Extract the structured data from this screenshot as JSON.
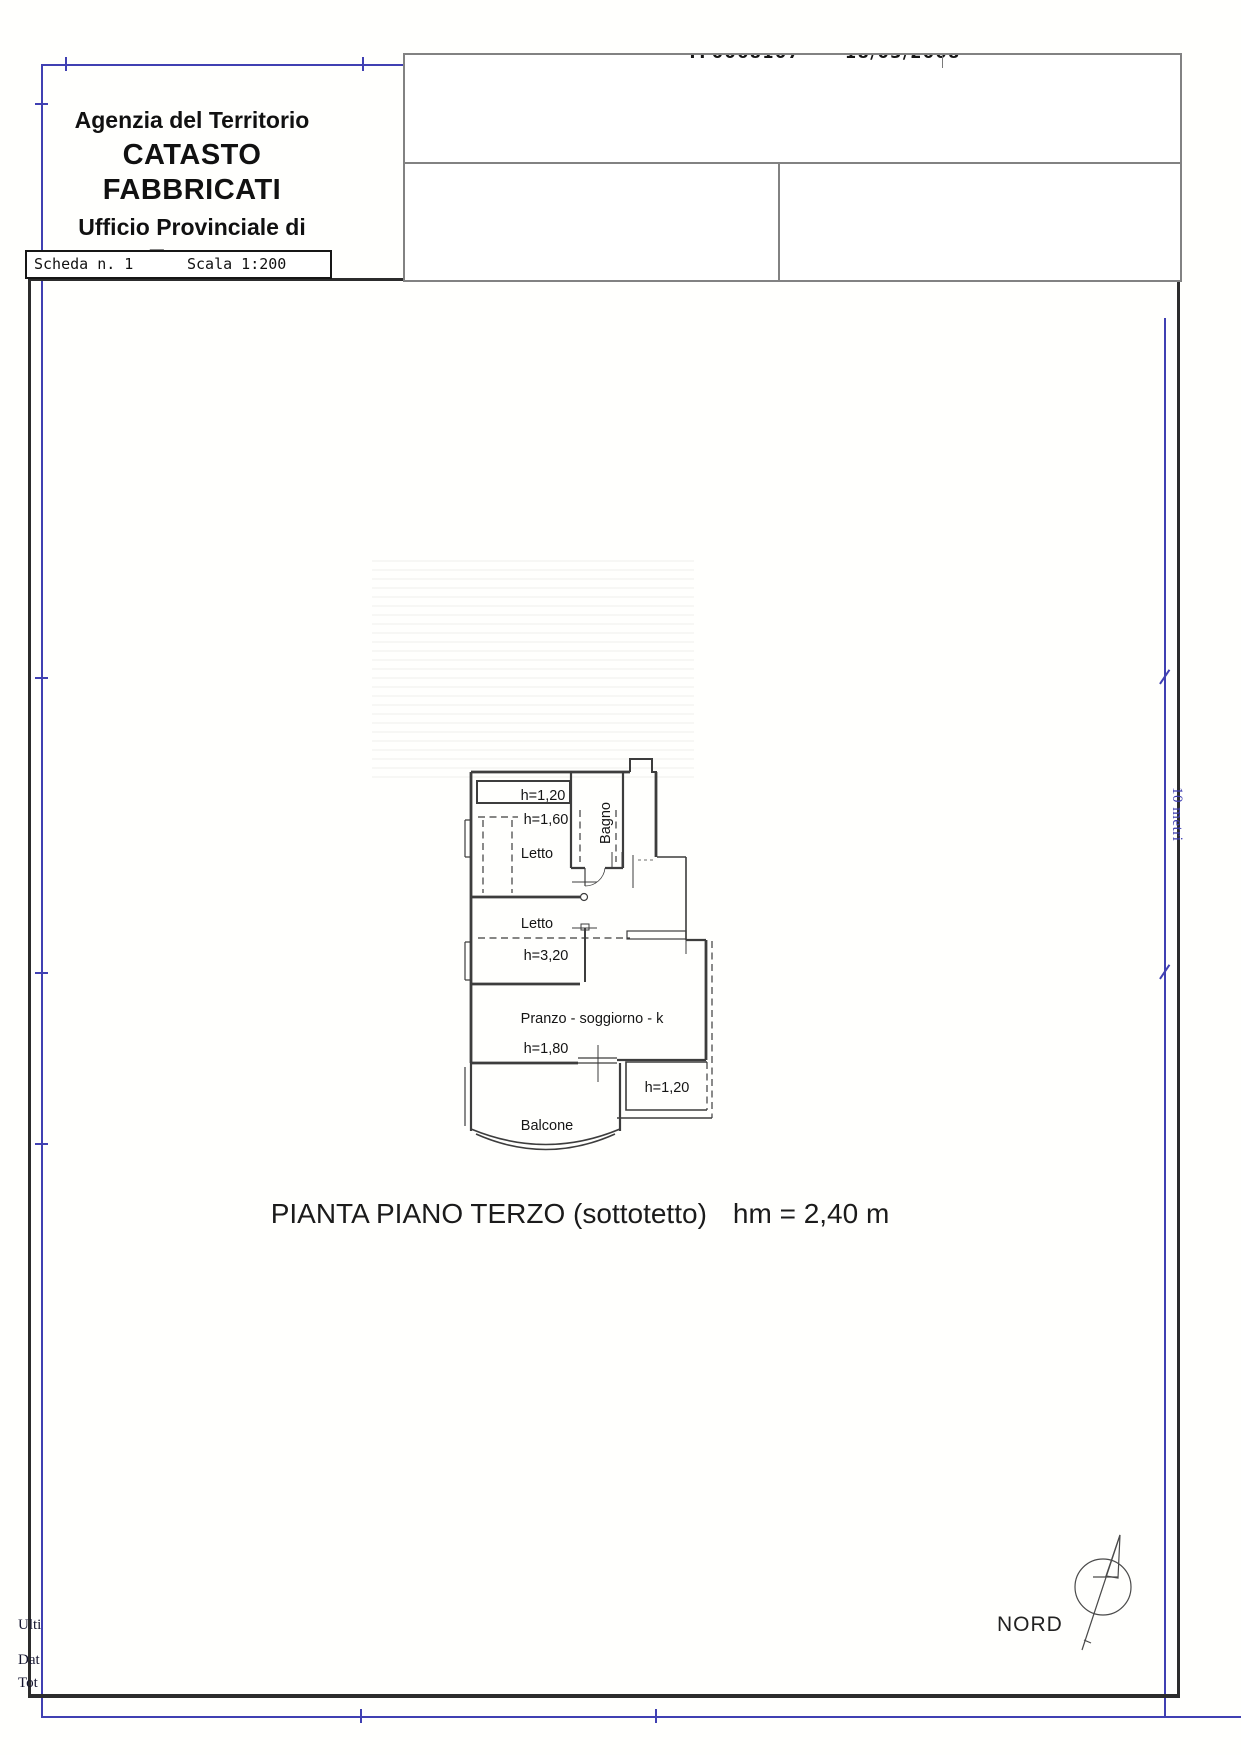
{
  "header": {
    "agency": "Agenzia del Territorio",
    "registry": "CATASTO FABBRICATI",
    "office_line": "Ufficio Provinciale di",
    "city": "Teramo"
  },
  "scheda_bar": {
    "scheda": "Scheda n. 1",
    "scala": "Scala 1:200"
  },
  "stamp_box": {
    "code_fragment": "TF0068107",
    "date_fragment": "18/03/2008"
  },
  "plan": {
    "labels": {
      "strip_height": "h=1,20",
      "letto1_height": "h=1,60",
      "letto1": "Letto",
      "bagno": "Bagno",
      "letto2": "Letto",
      "letto2_height": "h=3,20",
      "living": "Pranzo - soggiorno - k",
      "living_height": "h=1,80",
      "terrace_height": "h=1,20",
      "balcone": "Balcone"
    }
  },
  "caption": {
    "title": "PIANTA PIANO TERZO (sottotetto)",
    "height_note": "hm = 2,40 m"
  },
  "compass": {
    "label": "NORD"
  },
  "scale_bar": {
    "label": "10 metri"
  },
  "footer_fragments": {
    "f1": "Ulti",
    "f2": "Dat",
    "f3": "Tot"
  },
  "colors": {
    "frame_blue": "#4040b2",
    "plan_line": "#3d3d3d",
    "box_gray": "#828282"
  }
}
